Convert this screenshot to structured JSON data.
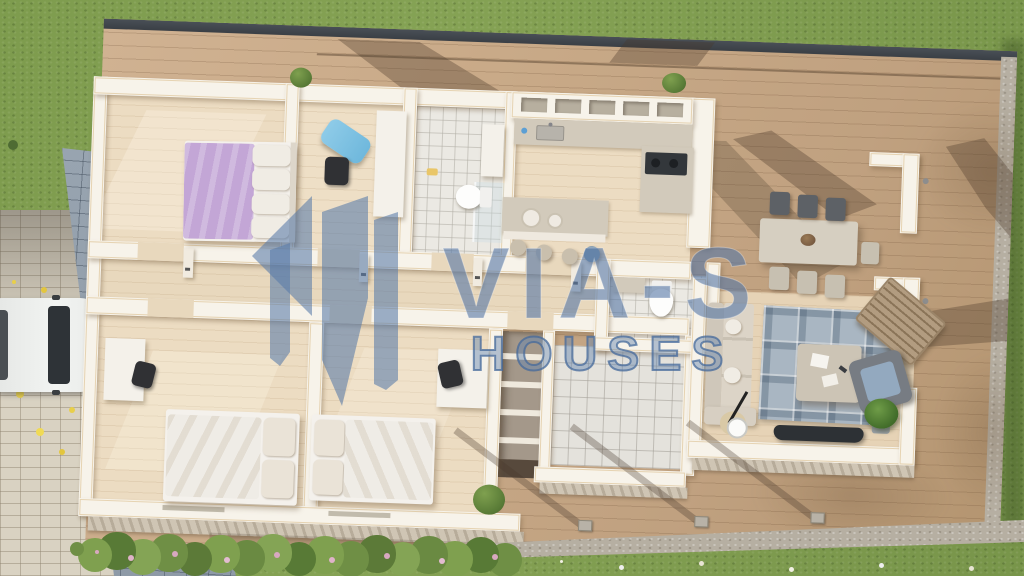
{
  "watermark": {
    "title": "VIA-S",
    "subtitle": "HOUSES",
    "logo": "twin-house-pillars-logo",
    "color": "#5a7dab"
  },
  "scene": {
    "description": "aerial 3d render of single-storey house floor plan on wooden deck",
    "palette": {
      "grass": "#7e9c4e",
      "gravel": "#b6afa2",
      "paver": "#d9d2c2",
      "path_blue": "#95a1ad",
      "deck_wood": "#c6a886",
      "deck_rim_dark": "#42474d",
      "wall_white": "#f7f3ea",
      "floor_wood": "#ecdcc2",
      "tile": "#ebe9e3",
      "bed_purple": "#c3a6d6",
      "linen_white": "#f0ece4",
      "sofa_beige": "#d8d0c3",
      "rug_blue": "#a9b6c2",
      "accent_chair_blue": "#8ecbe8",
      "cooktop_dark": "#33373b",
      "flower_yellow": "#e8cf4a",
      "hedge_green": "#6f8f45",
      "hedge_flower_pink": "#d8a8c0",
      "car_white": "#eef0ee"
    }
  }
}
